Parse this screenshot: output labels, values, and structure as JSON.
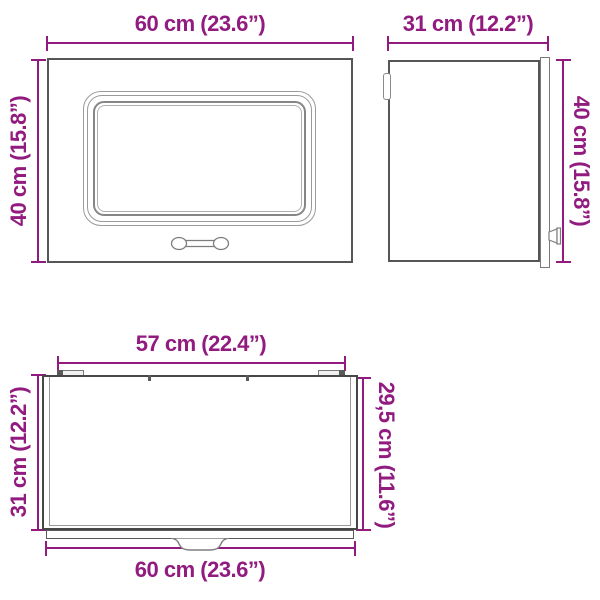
{
  "title": "Wall cabinet dimension diagram",
  "colors": {
    "dimension_accent": "#911b7f",
    "outline_dark": "#565656",
    "outline_light": "#9a9a9a",
    "fill": "#ffffff"
  },
  "views": {
    "front": {
      "top_dimension": "60 cm (23.6”)",
      "left_dimension": "40 cm (15.8”)"
    },
    "side": {
      "top_dimension": "31 cm (12.2”)",
      "right_dimension": "40 cm (15.8”)"
    },
    "top": {
      "top_dimension": "57 cm (22.4”)",
      "left_dimension": "31 cm (12.2”)",
      "right_dimension": "29,5 cm (11.6”)",
      "bottom_dimension": "60 cm (23.6”)"
    }
  }
}
